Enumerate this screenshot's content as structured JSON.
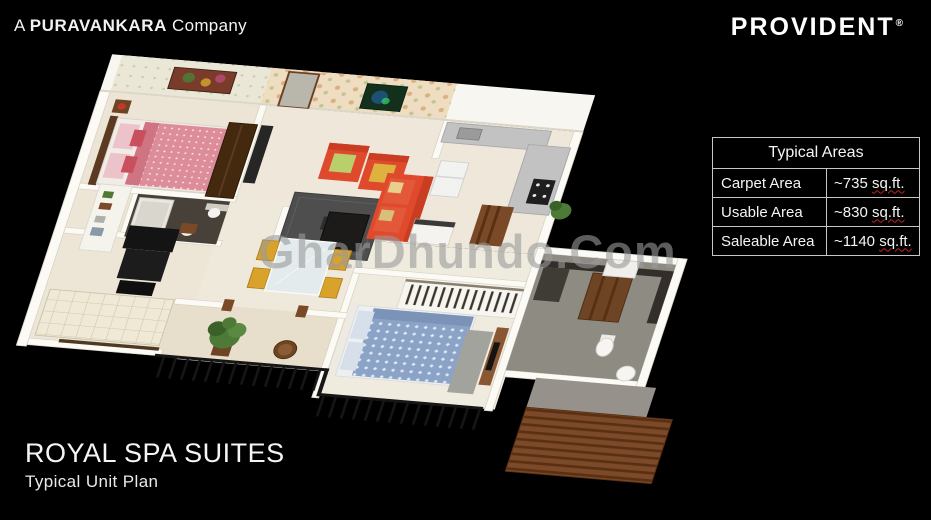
{
  "branding": {
    "left": {
      "prefix": "A",
      "name": "PURAVANKARA",
      "suffix": "Company"
    },
    "right": {
      "name": "PROVIDENT",
      "registered_mark": "®"
    }
  },
  "areas_table": {
    "title": "Typical Areas",
    "rows": [
      {
        "label": "Carpet Area",
        "value": "~735",
        "unit": "sq.ft."
      },
      {
        "label": "Usable Area",
        "value": "~830",
        "unit": "sq.ft."
      },
      {
        "label": "Saleable Area",
        "value": "~1140",
        "unit": "sq.ft."
      }
    ]
  },
  "project": {
    "title": "ROYAL SPA SUITES",
    "subtitle": "Typical Unit Plan"
  },
  "watermark": {
    "text": "GharDhundo.Com"
  },
  "floor_plan": {
    "type": "3d-isometric-unit-plan",
    "rooms": [
      "master-bedroom",
      "bathroom-1",
      "spa-room",
      "living-room",
      "dining-area",
      "kitchen",
      "bedroom-2",
      "bathroom-2",
      "balcony",
      "wooden-deck"
    ],
    "colors": {
      "background": "#000000",
      "walls": "#fbfaf5",
      "floor": "#efe8da",
      "sofa_red": "#df4a2c",
      "chair_yellow": "#d9a32b",
      "bed_blue": "#8ba3c7",
      "bed_pink": "#dd8d99",
      "wood": "#7a4a28",
      "railing": "#161616",
      "bath_tile": "#8e8b83",
      "rug": "#4e4e4e",
      "plant": "#4d7a36",
      "table_border": "#c7c7c7",
      "underline_red": "#c32222"
    }
  }
}
